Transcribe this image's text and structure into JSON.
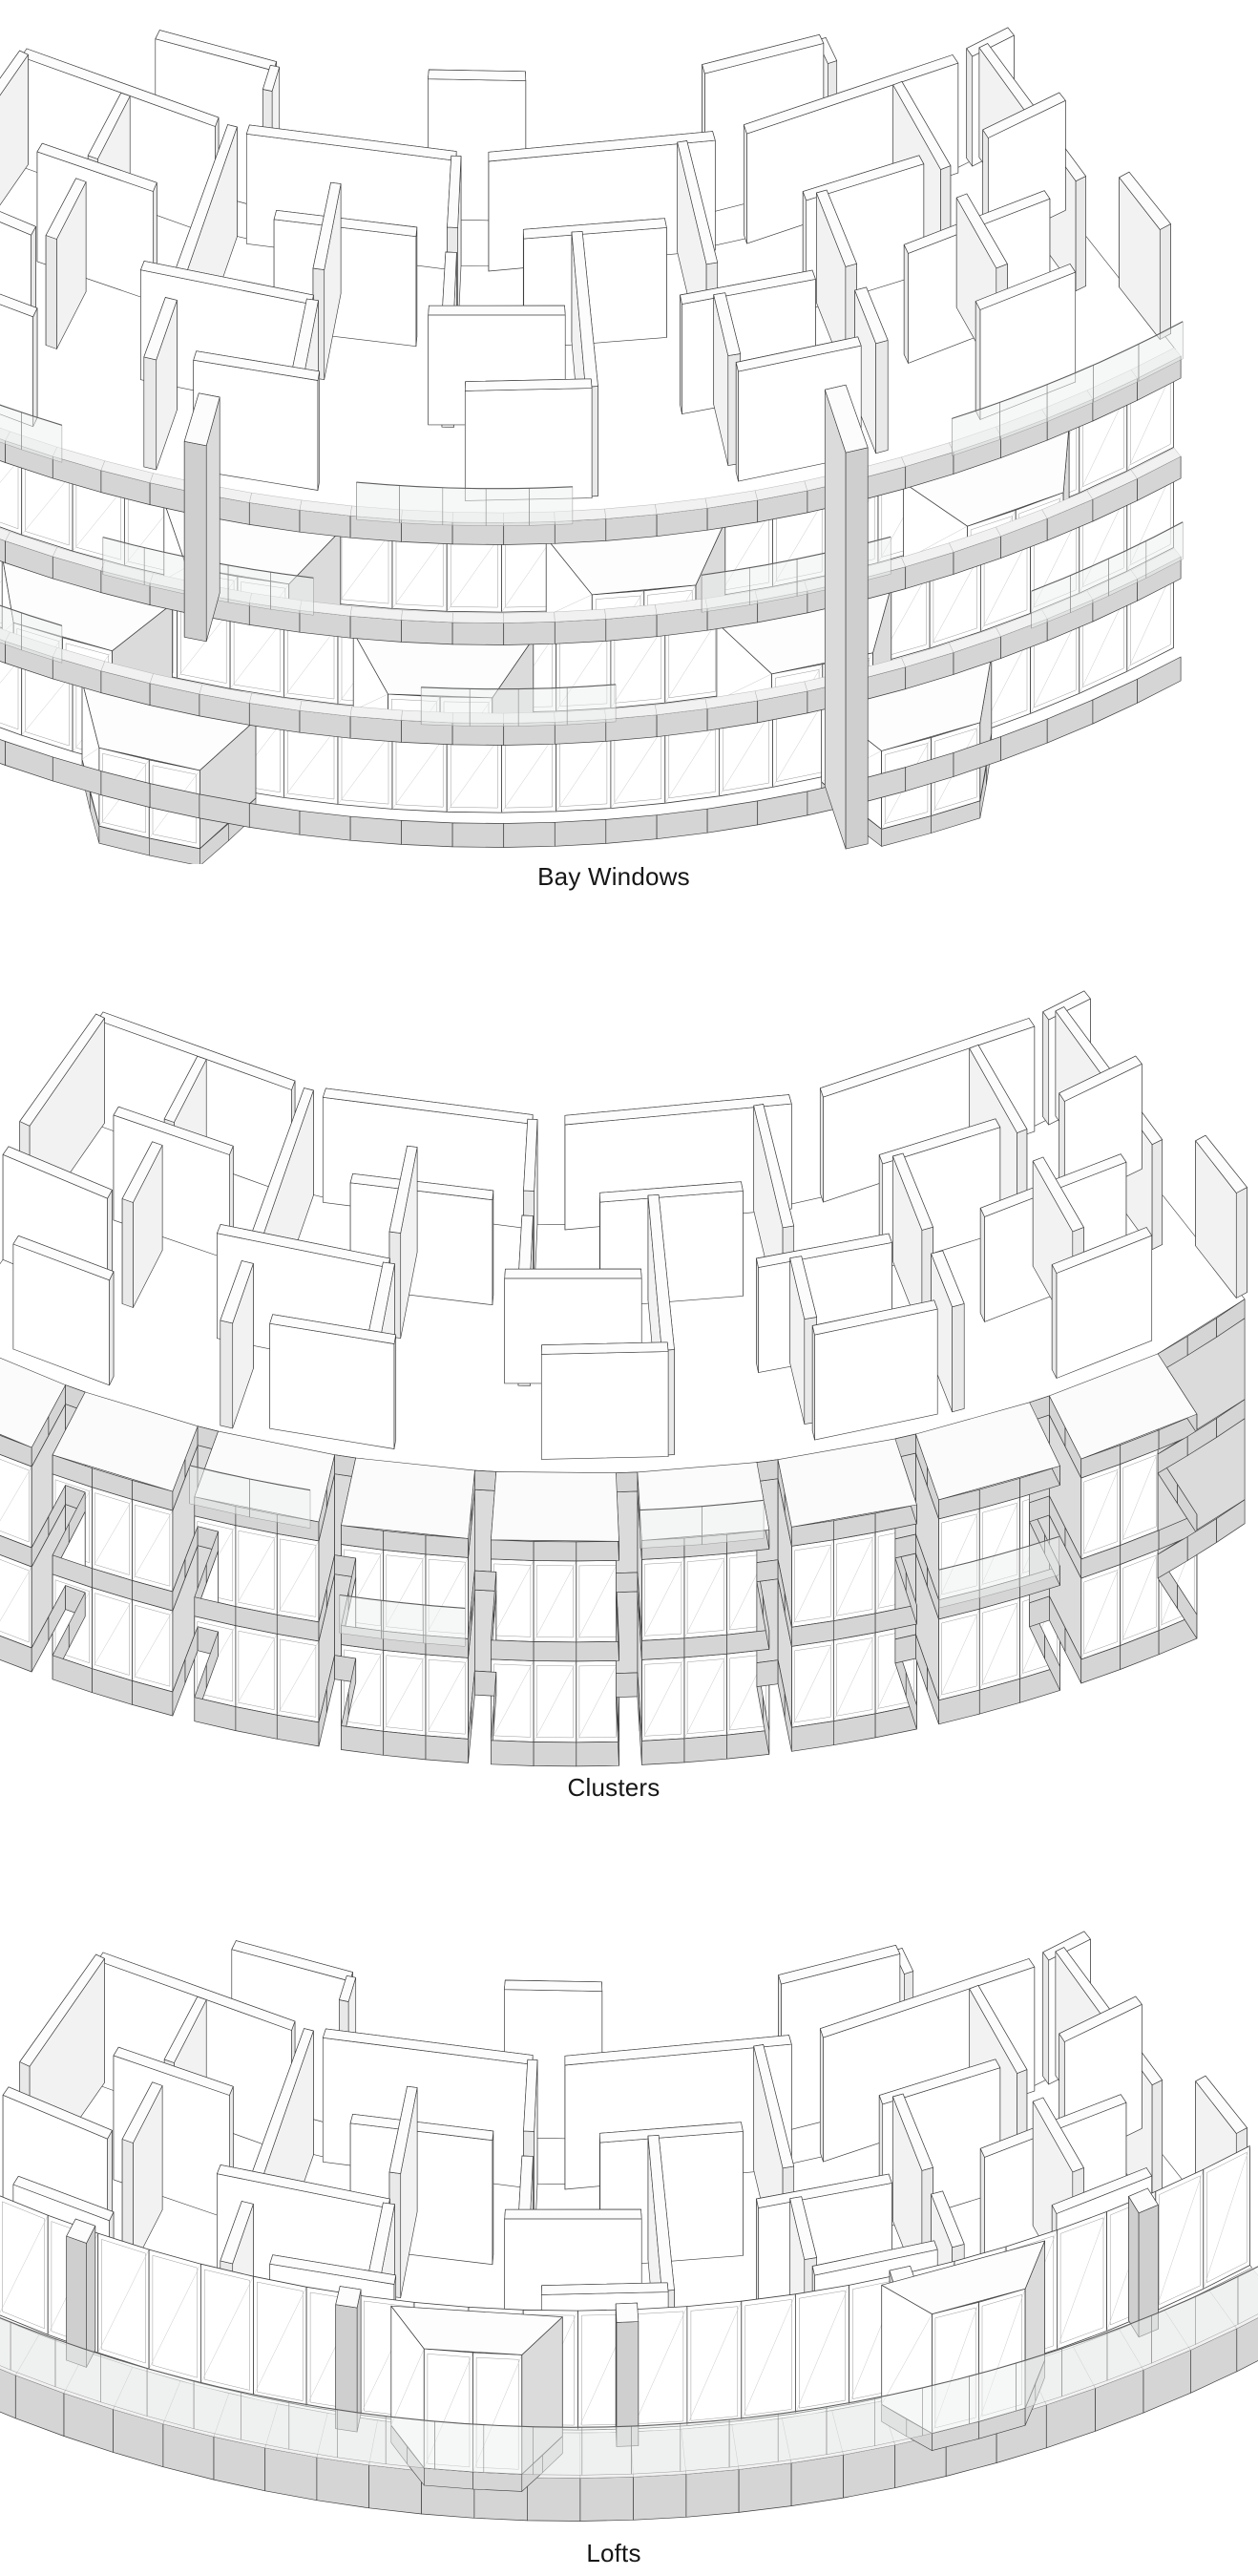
{
  "figures": [
    {
      "id": "bay-windows",
      "caption": "Bay Windows"
    },
    {
      "id": "clusters",
      "caption": "Clusters"
    },
    {
      "id": "lofts",
      "caption": "Lofts"
    }
  ],
  "palette": {
    "background": "#ffffff",
    "line": "#3f3f3f",
    "wall_white": "#ffffff",
    "face_side": "#f2f2f2",
    "cap": "#e9e9e9",
    "top": "#fcfcfc",
    "slab_gray": "#d5d5d5",
    "panel_gray": "#dbdbdb",
    "deck": "#f1f1f1",
    "glass_tint": "#edf0f0",
    "caption_color": "#161616"
  }
}
